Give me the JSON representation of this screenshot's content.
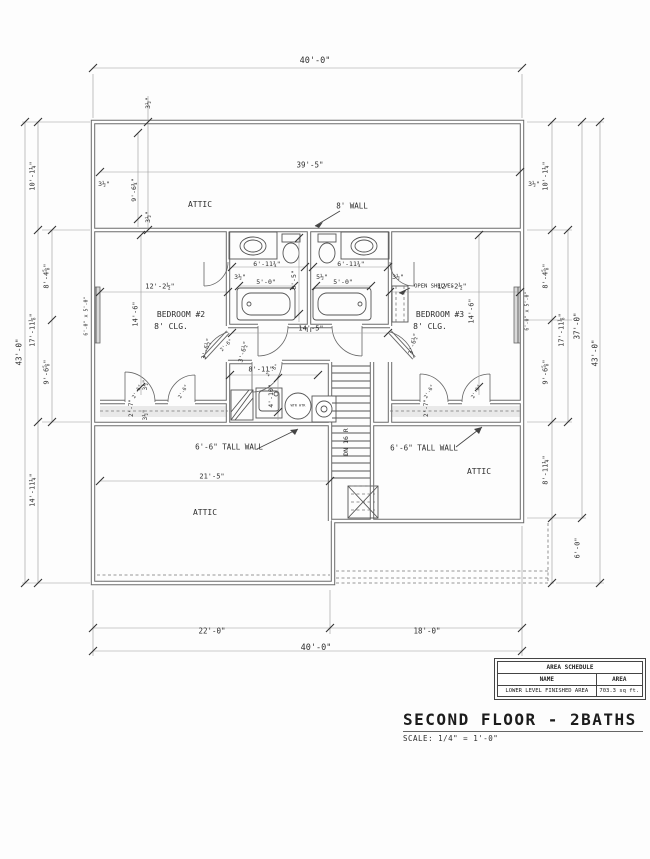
{
  "drawing": {
    "title": "SECOND FLOOR - 2BATHS",
    "scale_note": "SCALE: 1/4\" = 1'-0\"",
    "area_schedule": {
      "title": "AREA SCHEDULE",
      "columns": [
        "NAME",
        "AREA"
      ],
      "rows": [
        [
          "LOWER LEVEL FINISHED AREA",
          "703.3 sq ft."
        ]
      ]
    },
    "rooms": [
      "ATTIC",
      "BEDROOM #2",
      "BEDROOM #3",
      "ATTIC",
      "ATTIC"
    ],
    "labels": [
      {
        "name": "dim-40-top",
        "text": "40'-0\"",
        "x": 315,
        "y": 61,
        "fs": 8.5
      },
      {
        "name": "dim-39-5",
        "text": "39'-5\"",
        "x": 310,
        "y": 165,
        "fs": 7.5
      },
      {
        "name": "room-attic-top",
        "text": "ATTIC",
        "x": 200,
        "y": 205,
        "fs": 8
      },
      {
        "name": "note-8ft-wall",
        "text": "8' WALL",
        "x": 352,
        "y": 206,
        "fs": 7.5
      },
      {
        "name": "dim-6-11-left",
        "text": "6'-11¾\"",
        "x": 267,
        "y": 264,
        "fs": 6.5
      },
      {
        "name": "dim-6-11-right",
        "text": "6'-11¾\"",
        "x": 351,
        "y": 264,
        "fs": 6.5
      },
      {
        "name": "dim-3-5-bath-left",
        "text": "3½\"",
        "x": 240,
        "y": 277,
        "fs": 6.5
      },
      {
        "name": "dim-5-5-bath",
        "text": "5½\"",
        "x": 322,
        "y": 277,
        "fs": 6.5
      },
      {
        "name": "dim-3-5-bath-right",
        "text": "3½\"",
        "x": 398,
        "y": 277,
        "fs": 6.5
      },
      {
        "name": "note-open-shelves",
        "text": "OPEN SHELVES",
        "x": 434,
        "y": 287,
        "fs": 5.5
      },
      {
        "name": "dim-5-0-left",
        "text": "5'-0\"",
        "x": 266,
        "y": 282,
        "fs": 6.5
      },
      {
        "name": "dim-5-0-right",
        "text": "5'-0\"",
        "x": 343,
        "y": 282,
        "fs": 6.5
      },
      {
        "name": "dim-12-2-left",
        "text": "12'-2½\"",
        "x": 160,
        "y": 287,
        "fs": 7
      },
      {
        "name": "dim-12-2-right",
        "text": "12'-2½\"",
        "x": 452,
        "y": 287,
        "fs": 7
      },
      {
        "name": "room-bedroom2",
        "text": "BEDROOM #2",
        "x": 181,
        "y": 315,
        "fs": 8
      },
      {
        "name": "room-bedroom2-clg",
        "text": "8' CLG.",
        "x": 171,
        "y": 327,
        "fs": 8
      },
      {
        "name": "room-bedroom3",
        "text": "BEDROOM #3",
        "x": 440,
        "y": 315,
        "fs": 8
      },
      {
        "name": "room-bedroom3-clg",
        "text": "8' CLG.",
        "x": 430,
        "y": 327,
        "fs": 8
      },
      {
        "name": "dim-14-5",
        "text": "14'-5\"",
        "x": 311,
        "y": 329,
        "fs": 7
      },
      {
        "name": "dim-8-11",
        "text": "8'-11\"",
        "x": 261,
        "y": 370,
        "fs": 7
      },
      {
        "name": "note-tall-wall-left",
        "text": "6'-6\" TALL WALL",
        "x": 229,
        "y": 447,
        "fs": 7.5
      },
      {
        "name": "note-tall-wall-right",
        "text": "6'-6\" TALL WALL",
        "x": 424,
        "y": 448,
        "fs": 7.5
      },
      {
        "name": "dim-21-5",
        "text": "21'-5\"",
        "x": 212,
        "y": 477,
        "fs": 7
      },
      {
        "name": "room-attic-bottom-left",
        "text": "ATTIC",
        "x": 205,
        "y": 513,
        "fs": 8
      },
      {
        "name": "room-attic-bottom-right",
        "text": "ATTIC",
        "x": 479,
        "y": 472,
        "fs": 8
      },
      {
        "name": "dim-22-0",
        "text": "22'-0\"",
        "x": 212,
        "y": 631,
        "fs": 7.5
      },
      {
        "name": "dim-18-0",
        "text": "18'-0\"",
        "x": 427,
        "y": 631,
        "fs": 7.5
      },
      {
        "name": "dim-40-bottom",
        "text": "40'-0\"",
        "x": 316,
        "y": 648,
        "fs": 8.5
      },
      {
        "name": "note-water-heater",
        "text": "WTR HTR",
        "x": 298,
        "y": 406,
        "fs": 3.5
      },
      {
        "name": "dim-3-5-top",
        "text": "3½\"",
        "x": 148,
        "y": 103,
        "rot": -90,
        "fs": 6.5
      },
      {
        "name": "dim-9-6-attic",
        "text": "9'-6¾\"",
        "x": 134,
        "y": 190,
        "rot": -90,
        "fs": 6.5
      },
      {
        "name": "dim-3-5-attic-bottom",
        "text": "3½\"",
        "x": 148,
        "y": 217,
        "rot": -90,
        "fs": 6.5
      },
      {
        "name": "dim-3-5-attic-left",
        "text": "3½\"",
        "x": 104,
        "y": 184,
        "fs": 6.5
      },
      {
        "name": "dim-3-5-attic-right",
        "text": "3½\"",
        "x": 534,
        "y": 184,
        "fs": 6.5
      },
      {
        "name": "dim-10-1-left",
        "text": "10'-1¼\"",
        "x": 33,
        "y": 176,
        "rot": -90,
        "fs": 7
      },
      {
        "name": "dim-17-11-left",
        "text": "17'-11⅛\"",
        "x": 33,
        "y": 330,
        "rot": -90,
        "fs": 7
      },
      {
        "name": "dim-14-11-left",
        "text": "14'-11¼\"",
        "x": 33,
        "y": 490,
        "rot": -90,
        "fs": 7
      },
      {
        "name": "dim-43-left",
        "text": "43'-0\"",
        "x": 19,
        "y": 352,
        "rot": -90,
        "fs": 7.5
      },
      {
        "name": "dim-8-4-left",
        "text": "8'-4⅝\"",
        "x": 47,
        "y": 276,
        "rot": -90,
        "fs": 7
      },
      {
        "name": "dim-9-6-left",
        "text": "9'-6⅝\"",
        "x": 47,
        "y": 372,
        "rot": -90,
        "fs": 7
      },
      {
        "name": "window-left",
        "text": "6'-0\" x 5'-0\"",
        "x": 87,
        "y": 316,
        "rot": -90,
        "fs": 5
      },
      {
        "name": "dim-8-5",
        "text": "8'-5\"",
        "x": 294,
        "y": 280,
        "rot": -90,
        "fs": 6.5
      },
      {
        "name": "dim-14-6-left",
        "text": "14'-6\"",
        "x": 136,
        "y": 314,
        "rot": -90,
        "fs": 7
      },
      {
        "name": "dim-14-6-right",
        "text": "14'-6\"",
        "x": 472,
        "y": 311,
        "rot": -90,
        "fs": 7
      },
      {
        "name": "dim-4-10",
        "text": "4'-10\"",
        "x": 271,
        "y": 396,
        "rot": -90,
        "fs": 6.5
      },
      {
        "name": "dim-2-7-left",
        "text": "2'-7\"",
        "x": 132,
        "y": 408,
        "rot": -90,
        "fs": 6
      },
      {
        "name": "dim-3-5-closet-left-a",
        "text": "3½\"",
        "x": 146,
        "y": 385,
        "rot": -90,
        "fs": 6
      },
      {
        "name": "dim-3-5-closet-left-b",
        "text": "3½\"",
        "x": 146,
        "y": 415,
        "rot": -90,
        "fs": 6
      },
      {
        "name": "dim-2-7-right",
        "text": "2'-7\"",
        "x": 427,
        "y": 408,
        "rot": -90,
        "fs": 6
      },
      {
        "name": "note-dn-16r",
        "text": "DN 16 R",
        "x": 346,
        "y": 442,
        "rot": -90,
        "fs": 6.5
      },
      {
        "name": "window-right",
        "text": "6'-0\" x 5'-0\"",
        "x": 528,
        "y": 311,
        "rot": -90,
        "fs": 5
      },
      {
        "name": "dim-10-1-right",
        "text": "10'-1¼\"",
        "x": 546,
        "y": 176,
        "rot": -90,
        "fs": 7
      },
      {
        "name": "dim-8-4-right",
        "text": "8'-4⅝\"",
        "x": 546,
        "y": 276,
        "rot": -90,
        "fs": 7
      },
      {
        "name": "dim-9-6-right",
        "text": "9'-6⅝\"",
        "x": 546,
        "y": 372,
        "rot": -90,
        "fs": 7
      },
      {
        "name": "dim-8-11-right",
        "text": "8'-11¼\"",
        "x": 546,
        "y": 470,
        "rot": -90,
        "fs": 7
      },
      {
        "name": "dim-6-0-right",
        "text": "6'-0\"",
        "x": 578,
        "y": 548,
        "rot": -90,
        "fs": 7
      },
      {
        "name": "dim-17-11-right",
        "text": "17'-11⅛\"",
        "x": 562,
        "y": 330,
        "rot": -90,
        "fs": 7
      },
      {
        "name": "dim-37-right",
        "text": "37'-0\"",
        "x": 577,
        "y": 326,
        "rot": -90,
        "fs": 7.5
      },
      {
        "name": "dim-43-right",
        "text": "43'-0\"",
        "x": 595,
        "y": 353,
        "rot": -90,
        "fs": 7.5
      },
      {
        "name": "door-2-6-bed2-a",
        "text": "2'-6\"",
        "x": 138,
        "y": 392,
        "rot": -60,
        "fs": 5
      },
      {
        "name": "door-2-6-bed2-b",
        "text": "2'-6\"",
        "x": 184,
        "y": 392,
        "rot": -60,
        "fs": 5
      },
      {
        "name": "door-2-6-bed3-a",
        "text": "2'-6\"",
        "x": 430,
        "y": 392,
        "rot": -60,
        "fs": 5
      },
      {
        "name": "door-2-6-bed3-b",
        "text": "2'-6\"",
        "x": 477,
        "y": 392,
        "rot": -60,
        "fs": 5
      },
      {
        "name": "dim-3-6-bed2",
        "text": "3'-6½\"",
        "x": 207,
        "y": 349,
        "rot": -75,
        "fs": 6
      },
      {
        "name": "dim-3-6-hall",
        "text": "3'-6½\"",
        "x": 244,
        "y": 352,
        "rot": -75,
        "fs": 6
      },
      {
        "name": "dim-3-6-bed3",
        "text": "3'-6½\"",
        "x": 414,
        "y": 344,
        "rot": -75,
        "fs": 6
      },
      {
        "name": "door-2-6-hall-left",
        "text": "2'-6\"",
        "x": 227,
        "y": 346,
        "rot": -45,
        "fs": 5
      },
      {
        "name": "door-2-6-utility",
        "text": "2'-6\"",
        "x": 273,
        "y": 371,
        "rot": -45,
        "fs": 5
      }
    ]
  }
}
